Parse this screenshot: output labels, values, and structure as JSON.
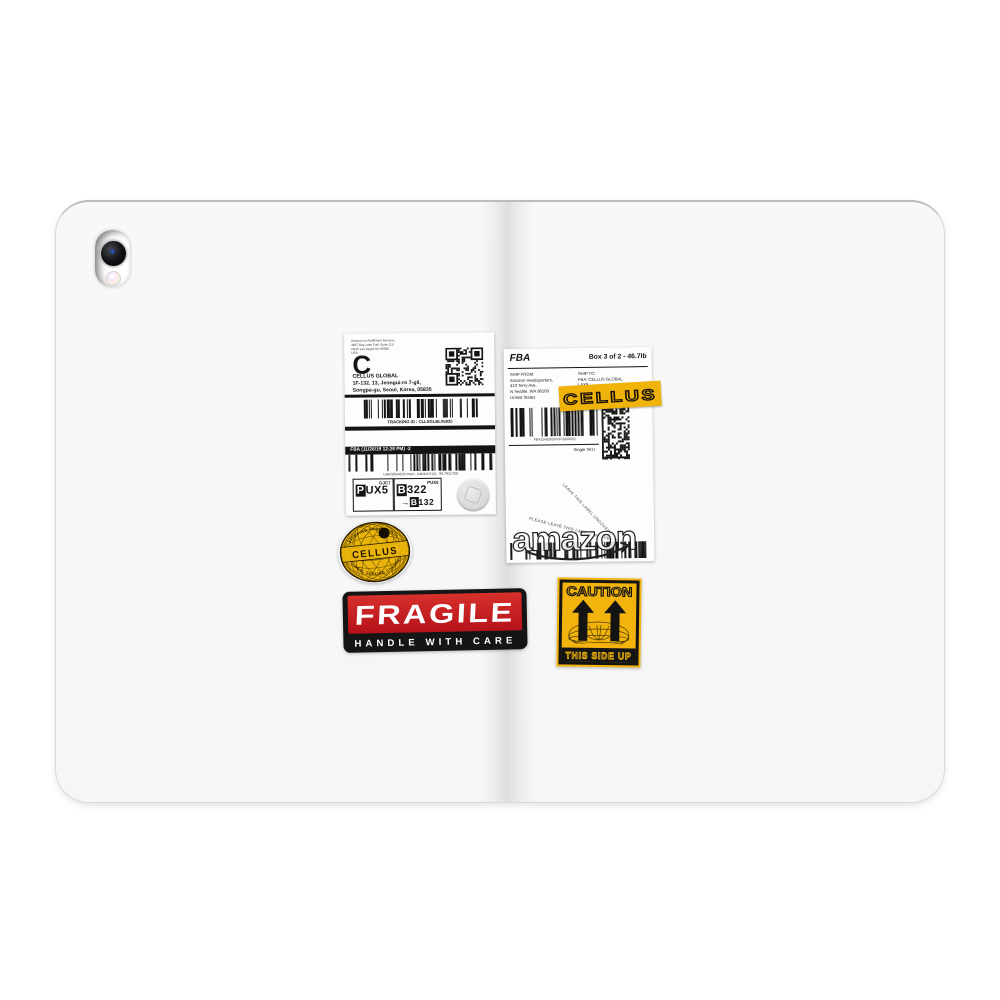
{
  "colors": {
    "brand_yellow": "#F0B30A",
    "fragile_red": "#C8191E",
    "ink_black": "#141414",
    "case_white": "#F7F7F8"
  },
  "shipping_label": {
    "sender_lines": [
      "Amazon.ca Fulfillment Services",
      "3837 Bay Lake Trail, Suite 113",
      "North Las Vegas NV 89030",
      "USA"
    ],
    "logo_letter": "C",
    "company": "CELLUS GLOBAL",
    "address_lines": [
      "1F-132, 13, Jeongui-ro 7-gil,",
      "Songpa-gu, Seoul, Korea, 05835"
    ],
    "tracking_id": "TRACKING ID : CLLSGLBL05835",
    "fba_bar": "FBA (11/26/19 12:28 PM) -2",
    "barcode_caption": "UAKG5toAB(1/med - 1dz/2of1/12) - 99.7931706",
    "sort_box_1": {
      "header": "GJC7",
      "value_prefix": "P",
      "value_rest": "UX5"
    },
    "sort_box_2": {
      "header": "PUX5",
      "line1_prefix": "B",
      "line1_rest": "322",
      "arrow": "→",
      "line2_prefix": "B",
      "line2_rest": "132"
    }
  },
  "fba_label": {
    "title": "FBA",
    "box_info": "Box 3 of 2 - 46.7lb",
    "ship_from_lines": [
      "SHIP FROM:",
      "Amazon Headquarters,",
      "410 Terry Ave.",
      "N Seattle, WA 98109",
      "United States"
    ],
    "ship_to_lines": [
      "SHIP TO:",
      "FBA: CELLUS GLOBAL",
      "LAX9",
      "11263 Oleander Ave."
    ],
    "tape_text": "CELLUS",
    "barcode_caption": "FBA15HD9SVVIFU006032",
    "sku_note": "Single SKU",
    "note_diagonal_1": "LEAVE THIS LABEL UNCOVERED",
    "note_diagonal_2": "PLEASE LEAVE THIS LABEL UNCOVERED",
    "amazon_logo_text": "amazon"
  },
  "globe_badge": {
    "arc_top": "SHIPPING FROM SEOUL",
    "name": "CELLUS",
    "arc_bottom": "GLOBAL SELLING CHANNEL"
  },
  "fragile_sticker": {
    "title": "FRAGILE",
    "subtitle": "HANDLE WITH CARE"
  },
  "caution_sticker": {
    "title": "CAUTION",
    "subtitle": "THIS SIDE UP"
  }
}
